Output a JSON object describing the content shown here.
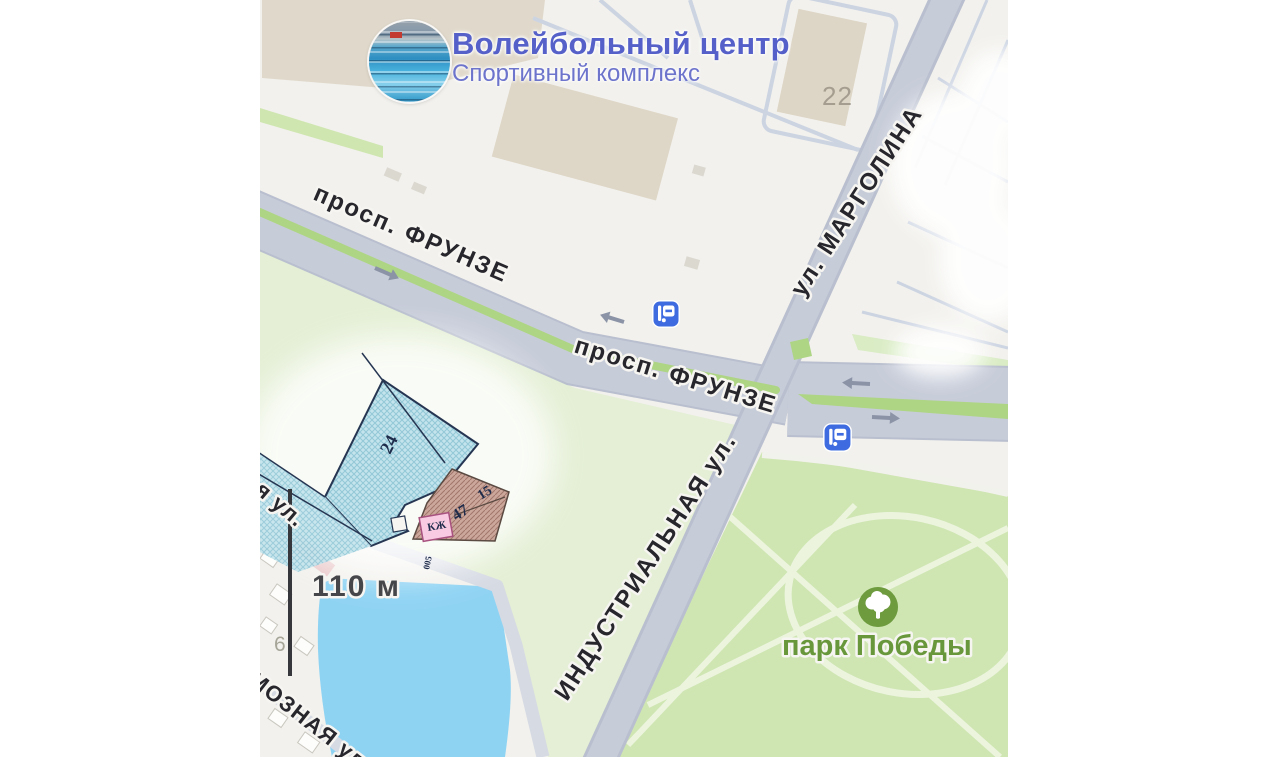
{
  "poi": {
    "title": "Волейбольный центр",
    "subtitle": "Спортивный комплекс",
    "avatar": "volleyball-arena-photo"
  },
  "streets": {
    "frunze": "просп. ФРУНЗЕ",
    "industrialnaya": "ИНДУСТРИАЛЬНАЯ ул.",
    "margolina": "ул. МАРГОЛИНА",
    "ya_fragment": "я ул.",
    "moznaya_fragment": "МОЗНАЯ ул."
  },
  "park": {
    "label": "парк Победы"
  },
  "scale": {
    "label": "110 м"
  },
  "house_numbers": {
    "n22": "22",
    "n6": "6"
  },
  "cadastral": {
    "parcel_24": "24",
    "parcel_15": "15",
    "parcel_47": "47",
    "building_kzh": "КЖ",
    "tiny_code": "005"
  },
  "icons": {
    "bus_stop": "bus-stop-icon",
    "park_tree": "tree-icon"
  },
  "colors": {
    "water": "#8fd3f3",
    "park": "#cfe6b3",
    "lawn": "#e4efd5",
    "road": "#c7ccd9",
    "road_casing": "#b9bfce",
    "median_green": "#aed584",
    "background": "#f2f1ed",
    "building_tan": "#e0d9cb",
    "cadastral_blue": "#c3e4ec",
    "cadastral_brown": "#cba79b",
    "cadastral_pink": "#f8cbe2",
    "poi_blue": "#5560c8",
    "park_label_green": "#68973b",
    "bus_icon_blue": "#3e6ce0",
    "street_text": "#26262c"
  }
}
